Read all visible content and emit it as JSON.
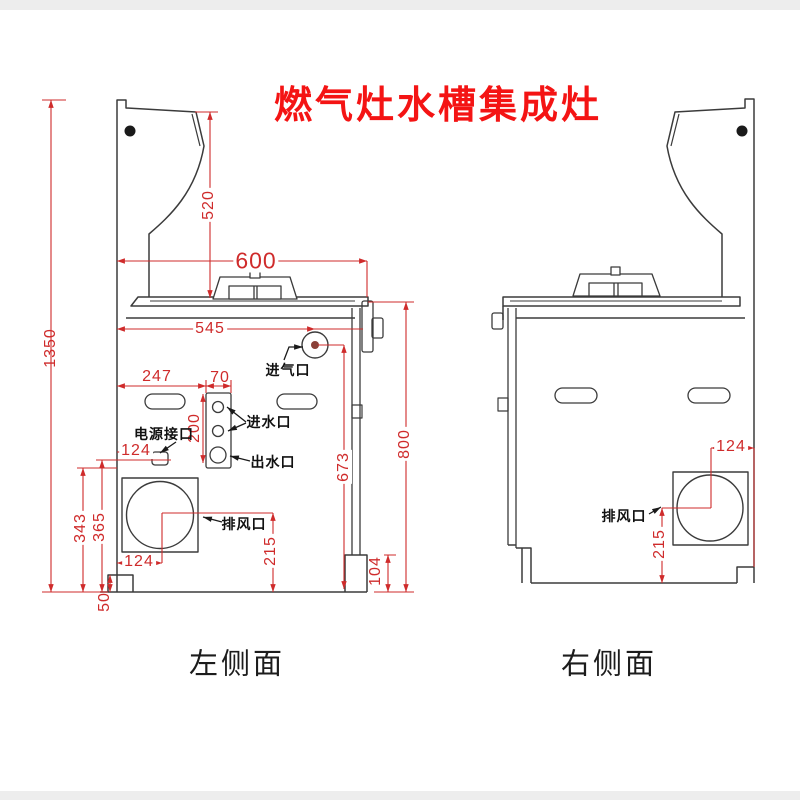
{
  "title": "燃气灶水槽集成灶",
  "captions": {
    "left": "左侧面",
    "right": "右侧面"
  },
  "left_view": {
    "labels": {
      "gas_inlet": "进气口",
      "power_socket": "电源接口",
      "water_inlet": "进水口",
      "water_outlet": "出水口",
      "exhaust": "排风口"
    },
    "dims": {
      "total_height": "1350",
      "hood_height": "520",
      "top_width": "600",
      "counter_depth": "545",
      "slot_offset": "247",
      "panel_width": "70",
      "panel_height": "200",
      "power_offset": "124",
      "rear_height": "673",
      "body_height": "800",
      "vent_upper": "343",
      "vent_lower": "365",
      "vent_offset": "124",
      "vent_height": "215",
      "foot_height_right": "104",
      "foot_height_left": "50"
    }
  },
  "right_view": {
    "labels": {
      "exhaust": "排风口"
    },
    "dims": {
      "vent_offset": "124",
      "vent_height": "215"
    }
  }
}
